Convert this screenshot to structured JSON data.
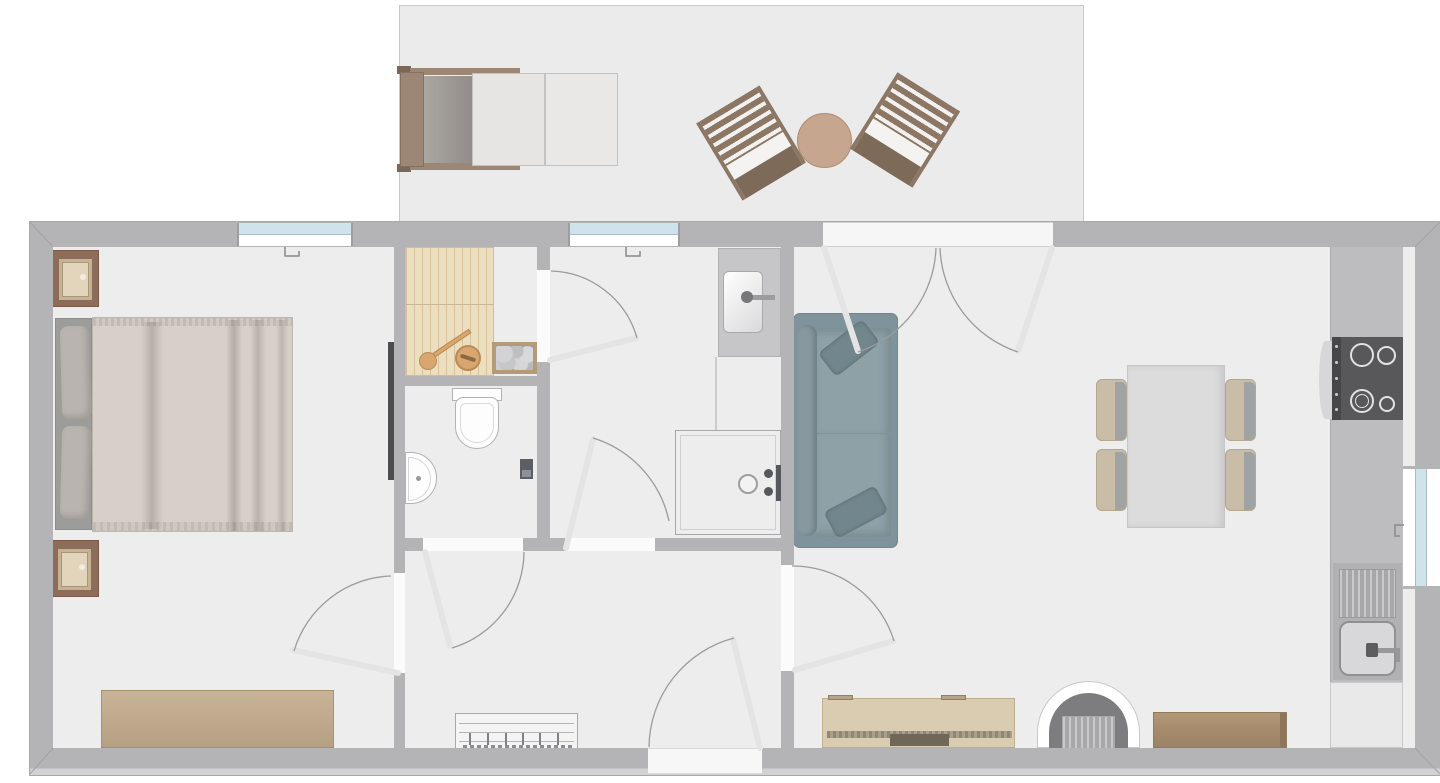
{
  "document": {
    "kind": "2d-floor-plan",
    "has_visible_text": false,
    "rooms": [
      {
        "name": "bedroom",
        "furniture": [
          "double-bed",
          "nightstand-with-lamp",
          "nightstand-with-lamp",
          "dresser",
          "wall-tv"
        ]
      },
      {
        "name": "sauna",
        "furniture": [
          "wood-bench-platform",
          "sauna-heater-with-stones",
          "water-bucket",
          "ladle"
        ]
      },
      {
        "name": "wc",
        "furniture": [
          "toilet",
          "corner-washbasin",
          "toilet-brush"
        ]
      },
      {
        "name": "shower-room",
        "furniture": [
          "vanity-with-basin",
          "walk-in-shower",
          "floor-drain",
          "shower-mixer"
        ]
      },
      {
        "name": "hallway",
        "furniture": [
          "shoe-rack"
        ]
      },
      {
        "name": "living-dining-kitchen",
        "furniture": [
          "two-seat-sofa",
          "dining-table",
          "dining-chair",
          "dining-chair",
          "dining-chair",
          "dining-chair",
          "kitchen-counter",
          "cooktop-4-burners",
          "oven",
          "kitchen-sink-with-drainboard",
          "base-cabinet",
          "tv-sideboard",
          "fireplace",
          "wooden-bench"
        ]
      },
      {
        "name": "terrace",
        "furniture": [
          "sun-lounger",
          "outdoor-chair",
          "outdoor-chair",
          "round-side-table"
        ]
      }
    ],
    "doors": [
      {
        "name": "entrance-door",
        "between": [
          "outside",
          "hallway"
        ]
      },
      {
        "name": "bedroom-door",
        "between": [
          "hallway",
          "bedroom"
        ]
      },
      {
        "name": "wc-door",
        "between": [
          "hallway",
          "wc"
        ]
      },
      {
        "name": "shower-room-door",
        "between": [
          "hallway",
          "shower-room"
        ]
      },
      {
        "name": "sauna-door",
        "between": [
          "shower-room",
          "sauna"
        ]
      },
      {
        "name": "living-room-door",
        "between": [
          "hallway",
          "living-dining-kitchen"
        ]
      },
      {
        "name": "terrace-double-door",
        "between": [
          "living-dining-kitchen",
          "terrace"
        ]
      }
    ],
    "windows": [
      {
        "name": "bedroom-window",
        "wall": "top"
      },
      {
        "name": "shower-room-window",
        "wall": "top"
      },
      {
        "name": "kitchen-window",
        "wall": "right"
      }
    ],
    "counts": {
      "dining_chairs": 4,
      "cooktop_burners": 4,
      "nightstands": 2,
      "outdoor_chairs": 2,
      "sofa_pillows": 2
    }
  },
  "palette": {
    "background": "#ffffff",
    "wall": "#b4b4b6",
    "floor": "#ededee",
    "terrace_floor": "#ebebec",
    "window_glass": "#cfe3ec",
    "door_leaf": "#e4e4e4",
    "door_arc": "#9b9b9b",
    "sauna_wood": "#ecdfc0",
    "heater_frame": "#b49a76",
    "sofa_body": "#7e939b",
    "sofa_seat": "#8da1a7",
    "dining_table": "#dcdcdd",
    "chair_tan": "#c9bda8",
    "chair_shadow": "#9fa3a4",
    "counter": "#bdbdbf",
    "cooktop": "#58585a",
    "sideboard": "#d9ccb1",
    "tv_dark": "#6f6858",
    "wood_bench": "#a98f72",
    "dresser": "#c0a98a",
    "nightstand": "#8d6c59",
    "duvet": "#d7d0c9",
    "bed_pillow": "#b9b4b0",
    "headboard": "#9c9c9a",
    "patio_wood": "#8c7664",
    "patio_table": "#c6a68f"
  }
}
